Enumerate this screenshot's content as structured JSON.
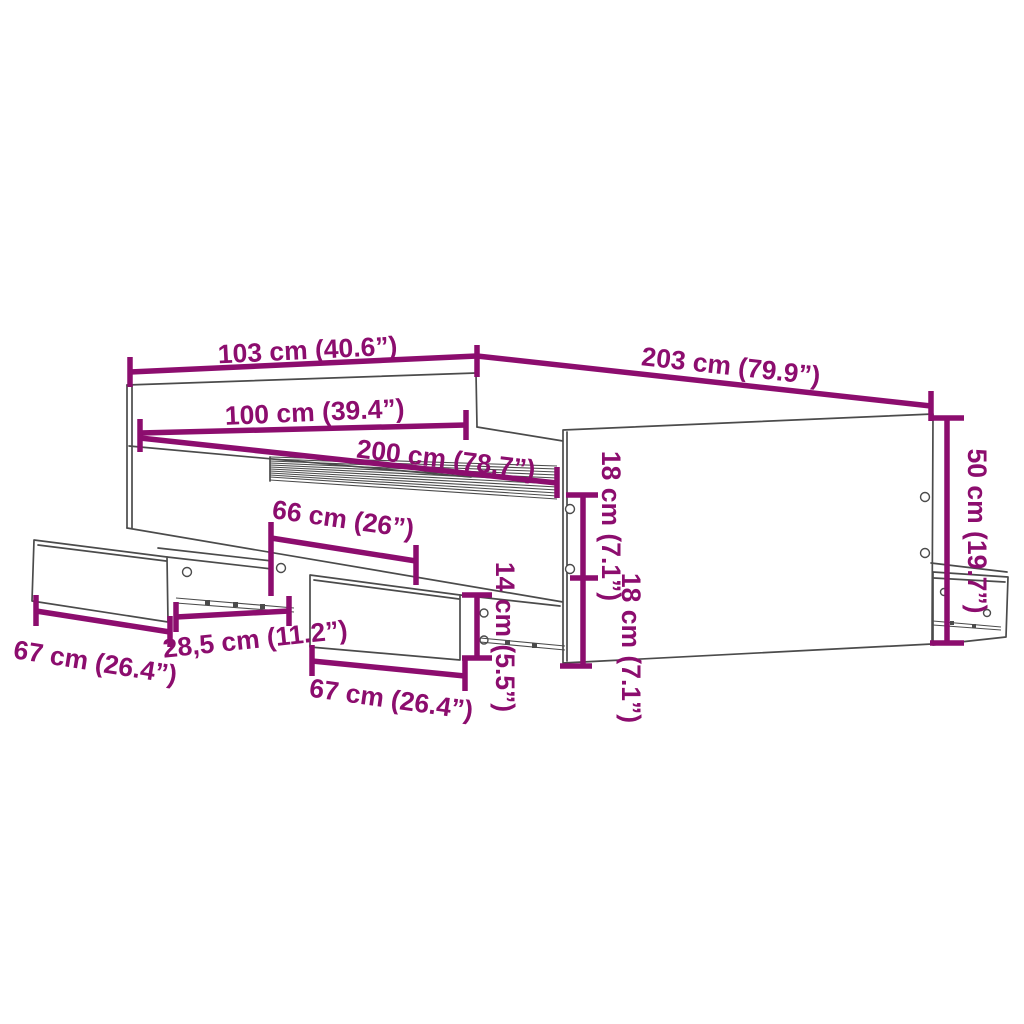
{
  "diagram": {
    "type": "furniture-dimension-diagram",
    "subject": "bed-frame-with-storage-drawers",
    "colors": {
      "dimension_color": "#8C0D6E",
      "outline_color": "#4B4B4B",
      "background": "#FFFFFF"
    },
    "labels": {
      "width_top": "103 cm (40.6”)",
      "length_top": "203 cm (79.9”)",
      "width_inner": "100 cm (39.4”)",
      "length_inner": "200 cm (78.7”)",
      "opening_width": "66 cm (26”)",
      "drawer_left_width": "67 cm (26.4”)",
      "gap_width": "28,5 cm (11.2”)",
      "drawer_middle_width": "67 cm (26.4”)",
      "drawer_middle_height": "14 cm (5.5”)",
      "rail_upper_height": "18 cm (7.1”)",
      "rail_lower_height": "18 cm (7.1”)",
      "side_height": "50 cm (19.7”)"
    }
  }
}
